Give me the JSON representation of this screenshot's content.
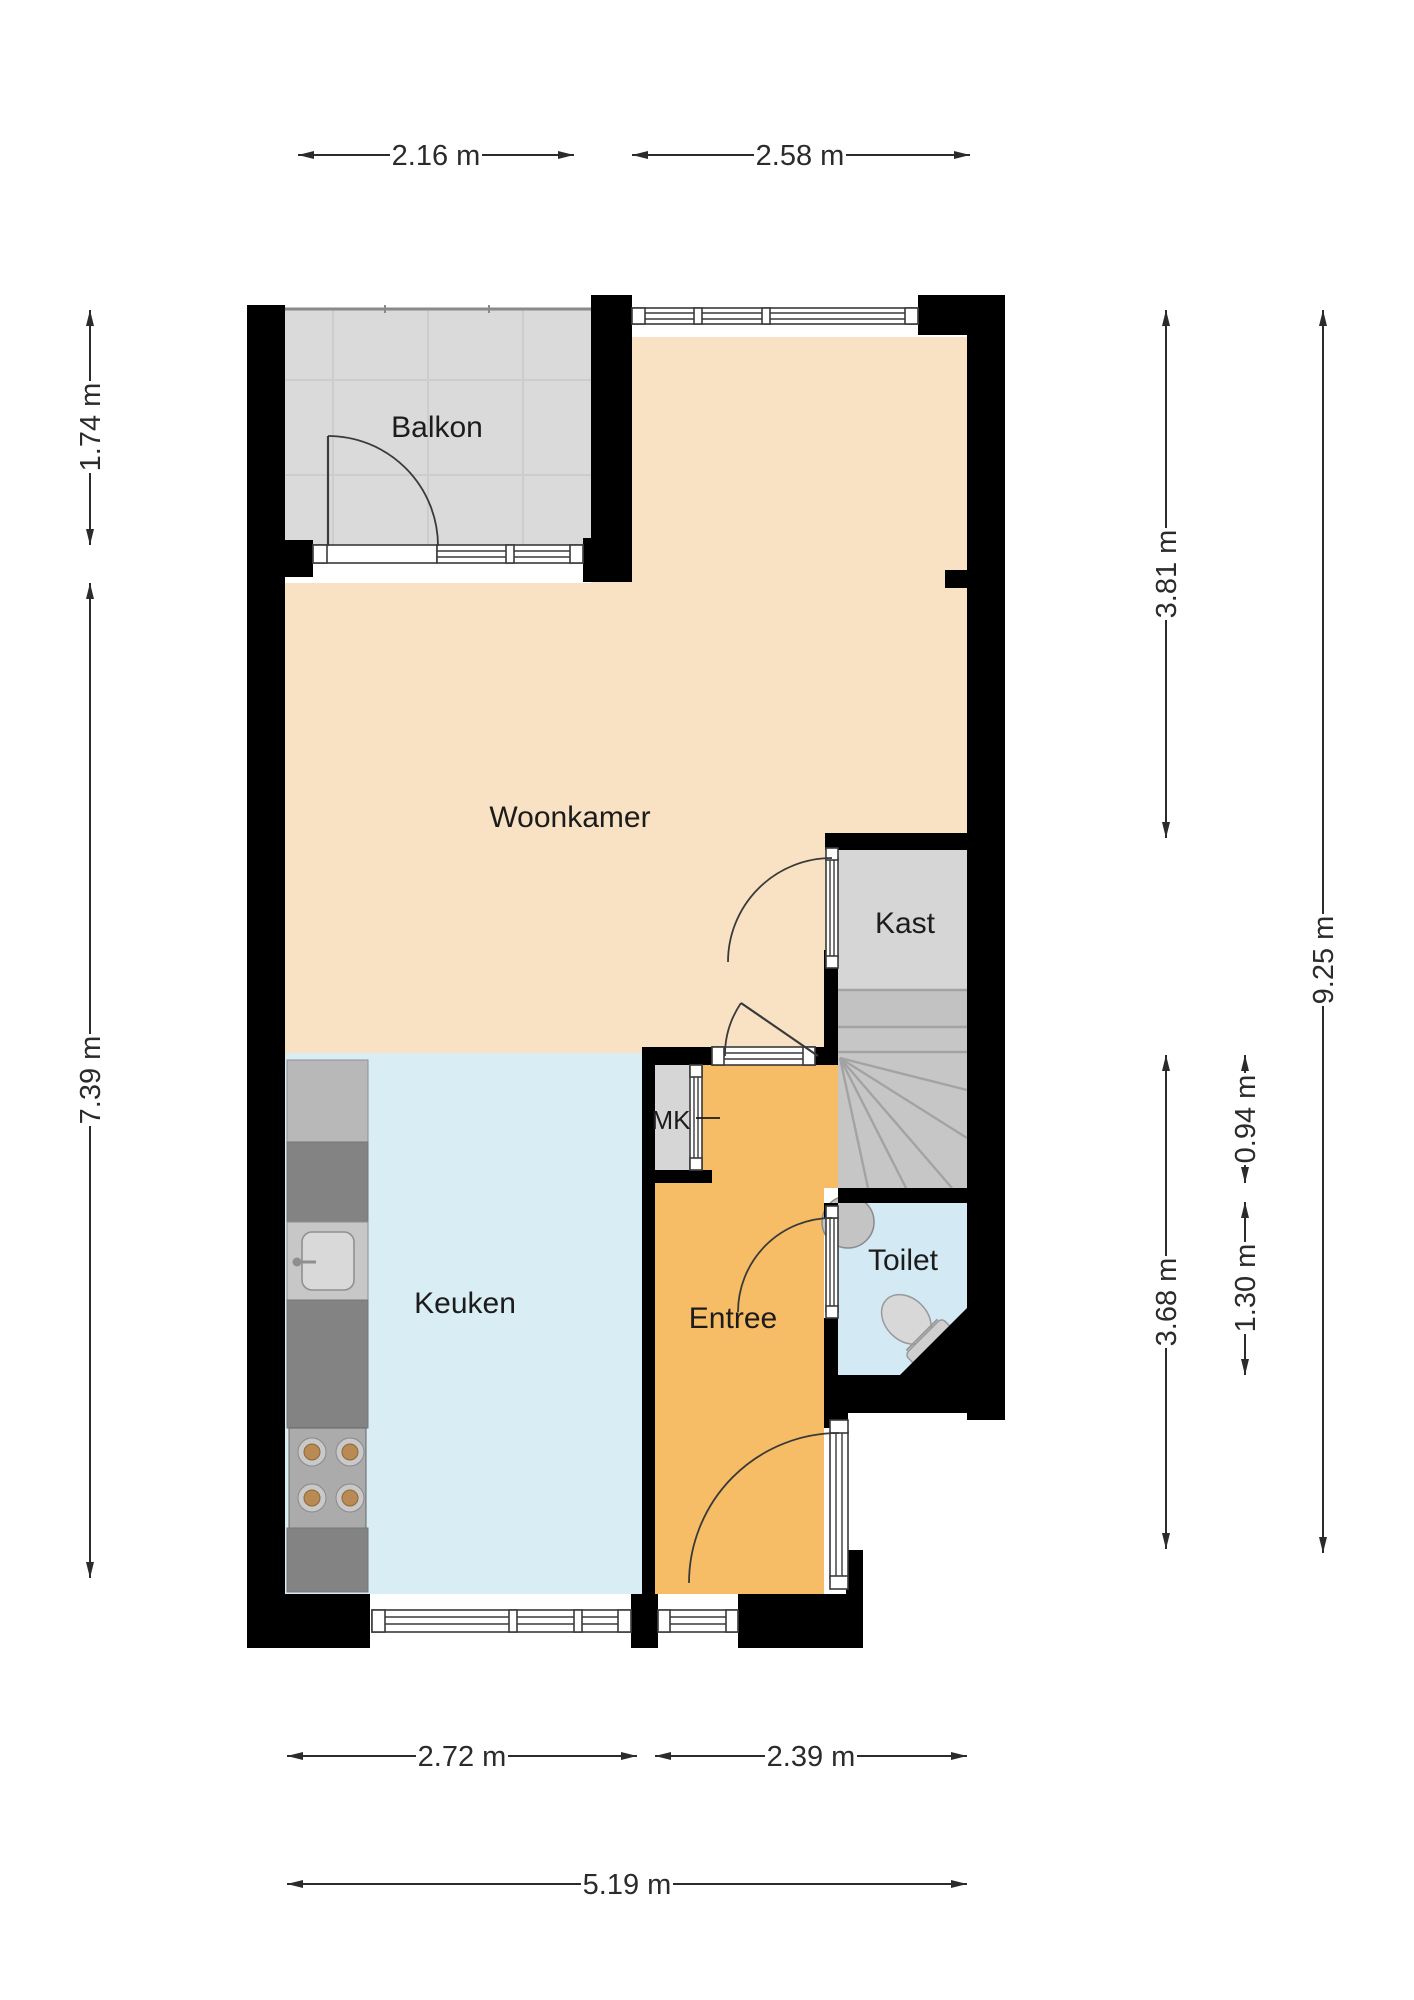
{
  "plan": {
    "rooms": {
      "balkon": "Balkon",
      "woonkamer": "Woonkamer",
      "kast": "Kast",
      "mk": "MK",
      "keuken": "Keuken",
      "entree": "Entree",
      "toilet": "Toilet"
    },
    "dimensions": {
      "top_balkon_width": "2.16 m",
      "top_woonkamer_width": "2.58 m",
      "left_balkon_depth": "1.74 m",
      "left_main_depth": "7.39 m",
      "right_woonkamer_height": "3.81 m",
      "right_total_height": "9.25 m",
      "right_mk_height": "0.94 m",
      "right_toilet_height": "1.30 m",
      "right_entree_height": "3.68 m",
      "bottom_keuken_width": "2.72 m",
      "bottom_entree_width": "2.39 m",
      "bottom_total_width": "5.19 m"
    },
    "colors": {
      "wall": "#000000",
      "woonkamer": "#f9e2c4",
      "entree": "#f6bd66",
      "keuken": "#d9edf5",
      "toilet": "#d3e9f3",
      "balkon": "#dadada",
      "kast": "#d6d6d6",
      "stairs": "#c6c6c6",
      "counter_dark": "#838383",
      "counter_light": "#b8b8b8",
      "burner": "#b98a54"
    }
  }
}
